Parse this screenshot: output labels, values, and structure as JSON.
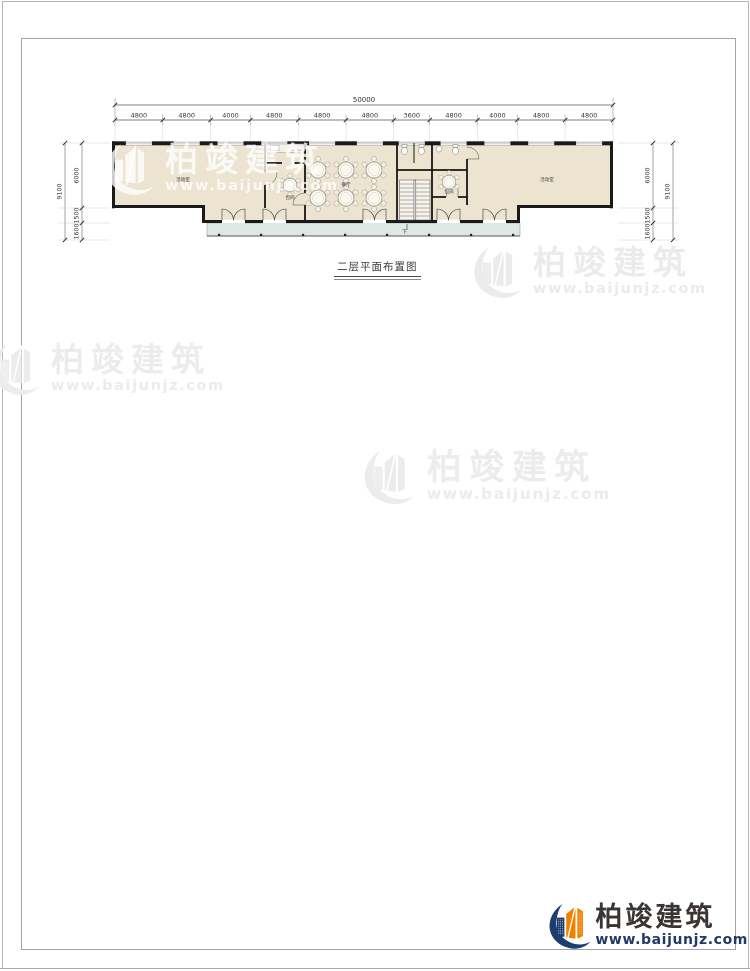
{
  "drawing": {
    "caption": "二层平面布置图",
    "stair_label": "下",
    "rooms": {
      "left": "活动室",
      "dining": "餐厅",
      "private_a": "包间",
      "private_b": "包间",
      "right": "活动室"
    }
  },
  "dimensions": {
    "total_width": "50000",
    "top_segments": [
      "4800",
      "4800",
      "4000",
      "4800",
      "4800",
      "4800",
      "3600",
      "4800",
      "4000",
      "4800",
      "4800"
    ],
    "left": {
      "overall": "9100",
      "segments": [
        "6000",
        "1500",
        "1600"
      ]
    },
    "right": {
      "overall": "9100",
      "segments": [
        "6000",
        "1500",
        "1600"
      ]
    }
  },
  "watermark": {
    "name": "柏竣建筑",
    "url": "www.baijunjz.com"
  },
  "brand": {
    "name": "柏竣建筑",
    "url": "www.baijunjz.com"
  },
  "colors": {
    "wall": "#1a1a1a",
    "floor_fill": "#ece4d0",
    "balcony_fill": "#dde8e4",
    "brand_navy": "#1d3e6e",
    "brand_orange": "#f08200",
    "watermark_gray": "#ebebeb"
  }
}
